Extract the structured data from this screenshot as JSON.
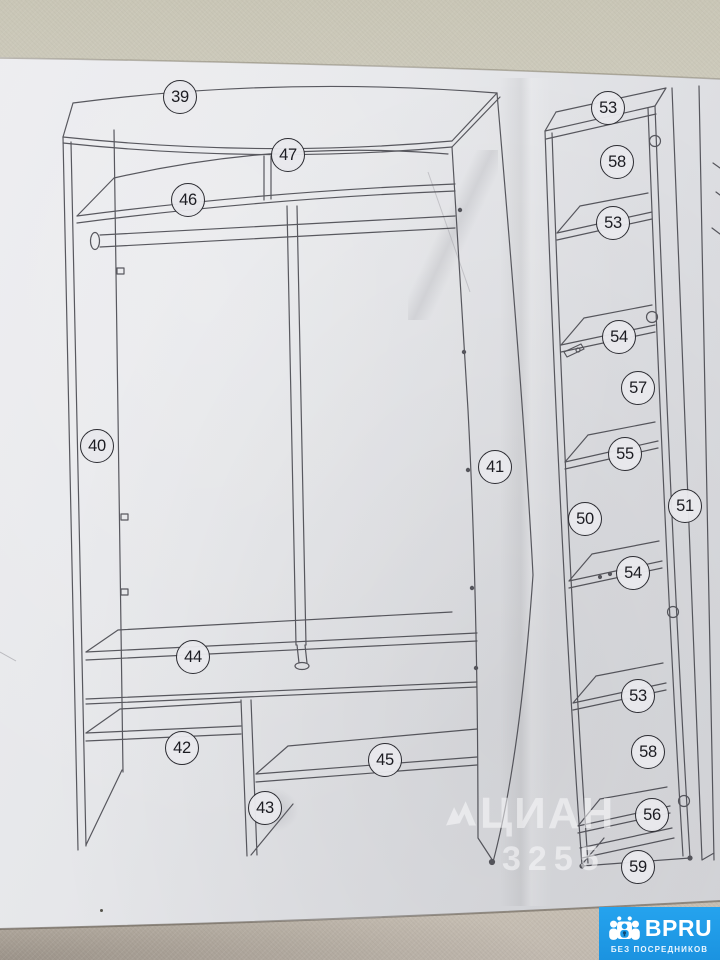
{
  "wardrobe": {
    "callouts": [
      {
        "label": "39"
      },
      {
        "label": "47"
      },
      {
        "label": "46"
      },
      {
        "label": "40"
      },
      {
        "label": "41"
      },
      {
        "label": "44"
      },
      {
        "label": "42"
      },
      {
        "label": "45"
      },
      {
        "label": "43"
      }
    ]
  },
  "unit": {
    "callouts": [
      {
        "label": "53"
      },
      {
        "label": "58"
      },
      {
        "label": "53"
      },
      {
        "label": "54"
      },
      {
        "label": "57"
      },
      {
        "label": "55"
      },
      {
        "label": "51"
      },
      {
        "label": "50"
      },
      {
        "label": "54"
      },
      {
        "label": "53"
      },
      {
        "label": "58"
      },
      {
        "label": "56"
      },
      {
        "label": "59"
      }
    ]
  },
  "watermark": {
    "text": "ЦИАН",
    "number": "3255"
  },
  "badge": {
    "brand": "BPRU",
    "tagline": "БЕЗ ПОСРЕДНИКОВ",
    "color": "#1e9ce8"
  }
}
